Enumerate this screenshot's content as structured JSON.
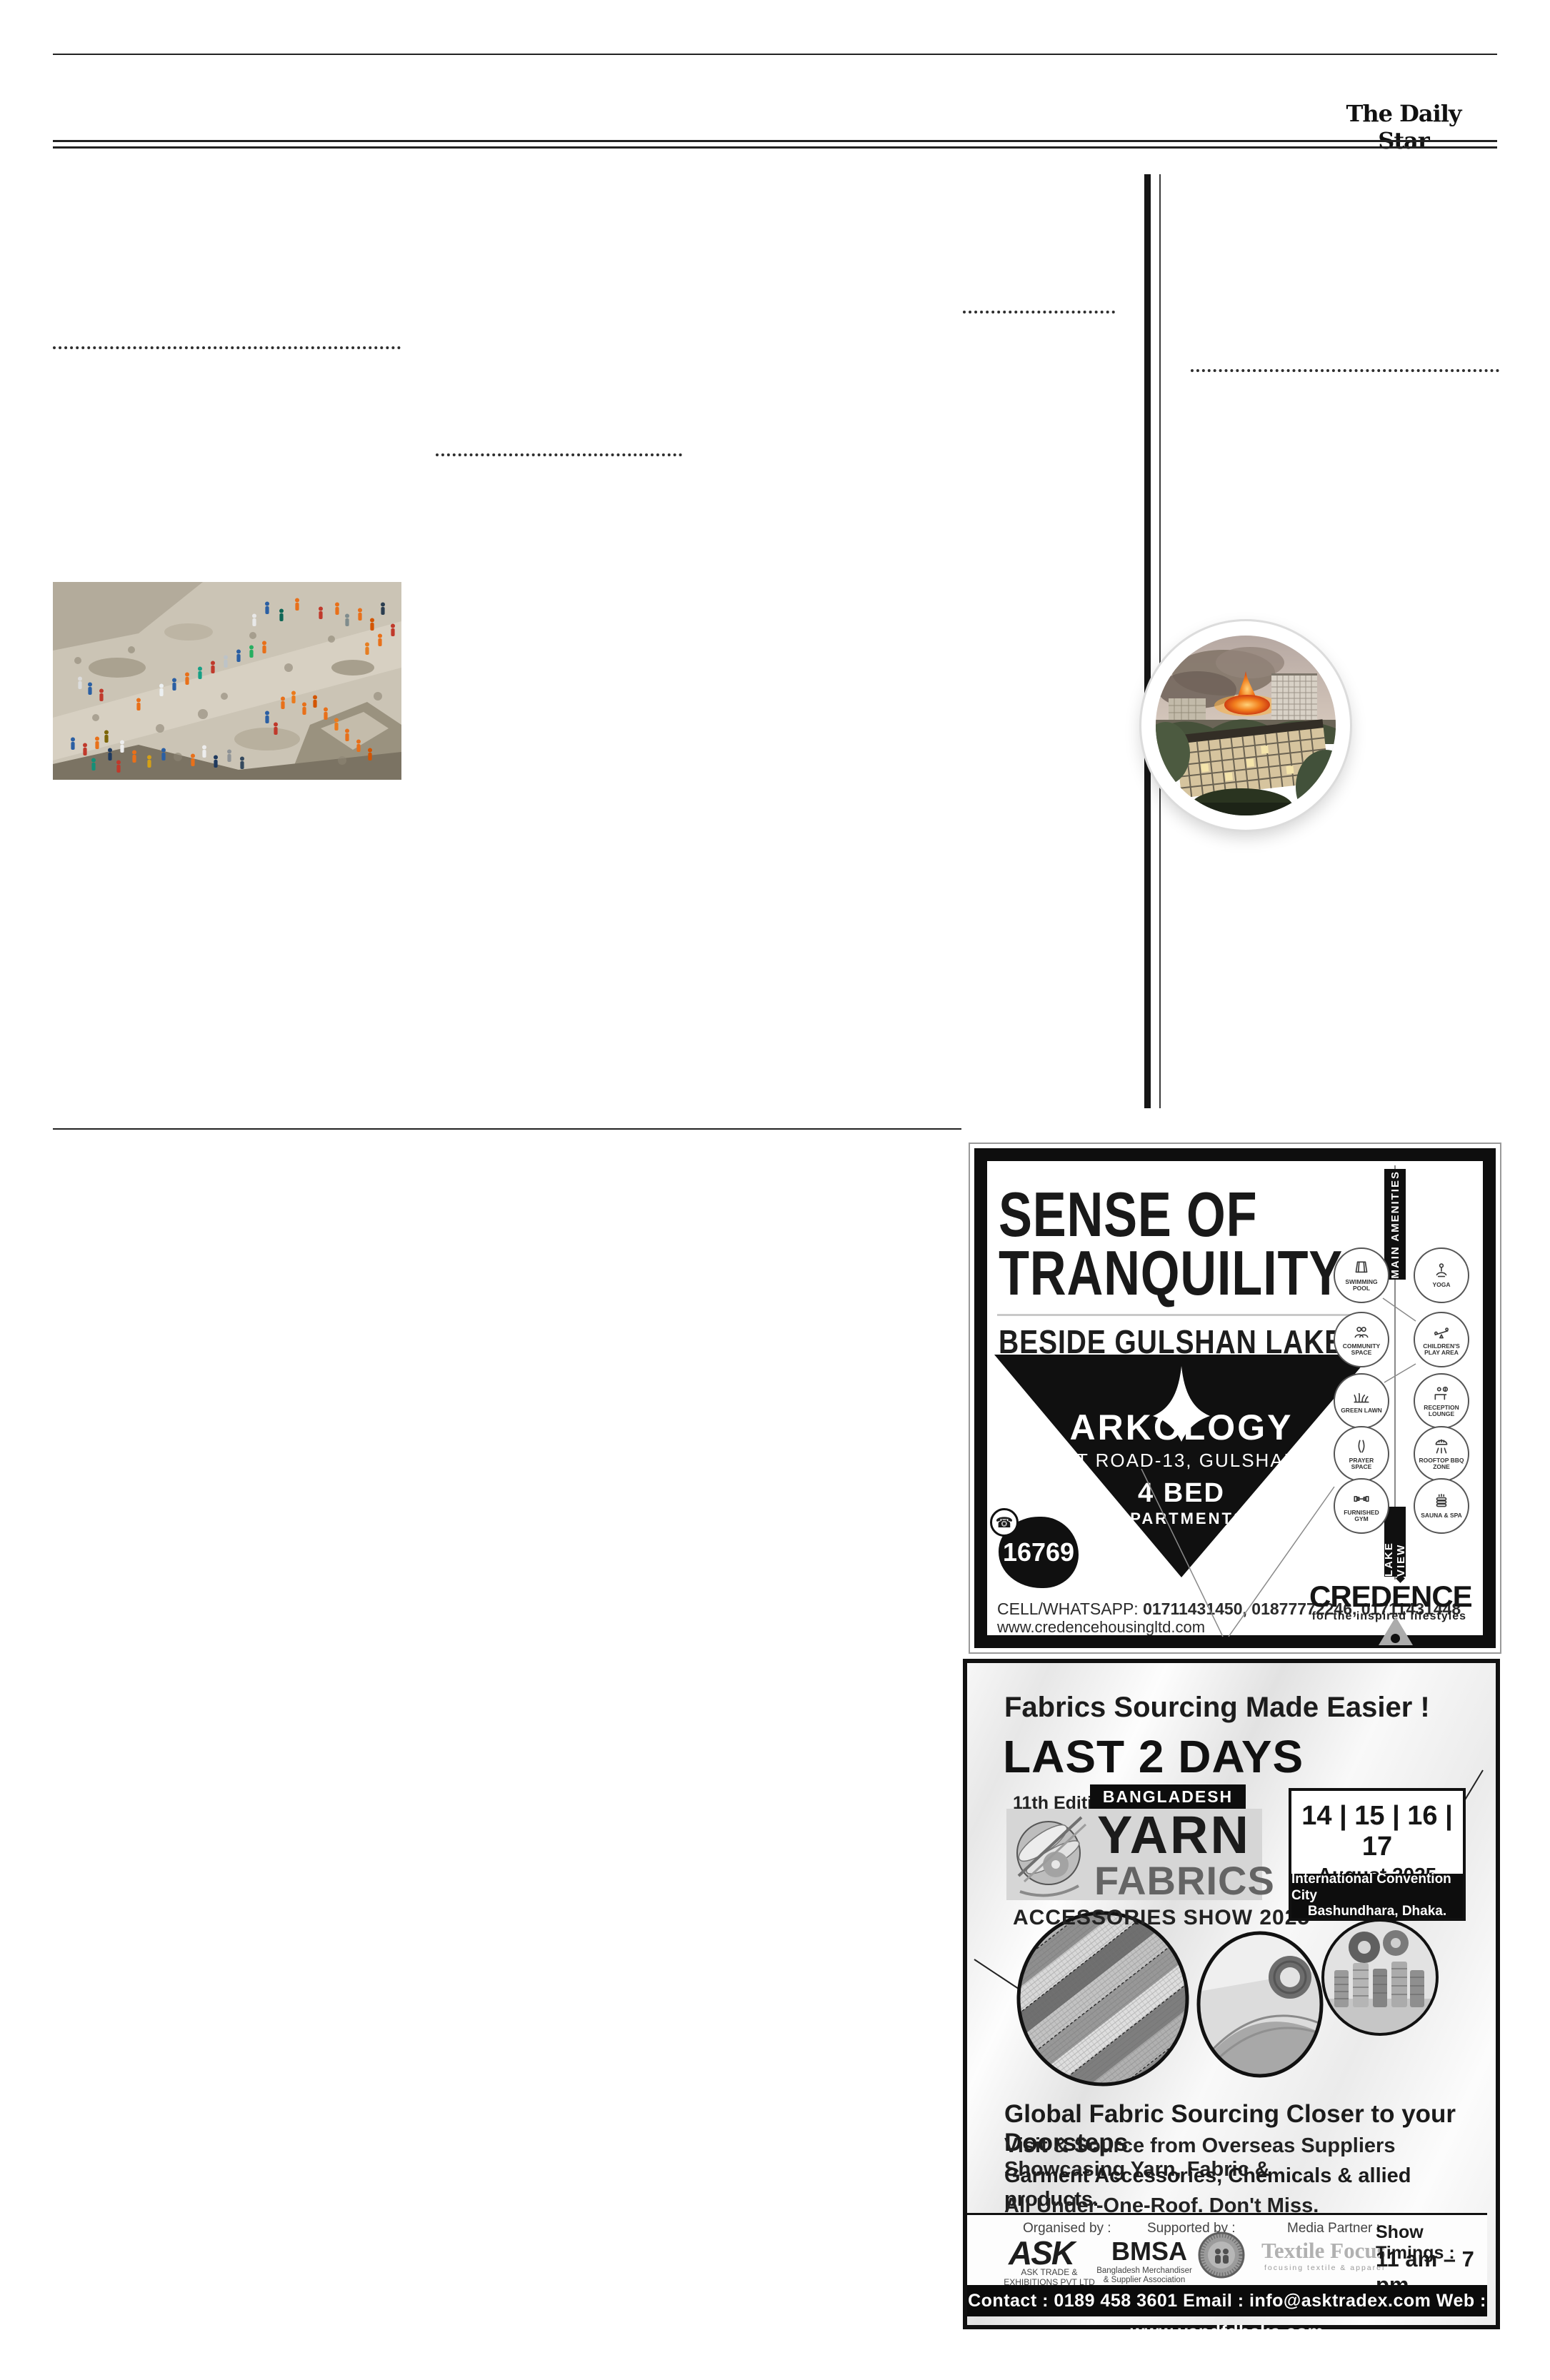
{
  "masthead": {
    "title": "The Daily Star"
  },
  "icons": {
    "phone_glyph": "☎"
  },
  "arkology_ad": {
    "headline_line1": "SENSE OF",
    "headline_line2": "TRANQUILITY",
    "subheadline": "BESIDE GULSHAN LAKE.",
    "brand": "ARKOLOGY",
    "address": "AT ROAD-13, GULSHAN",
    "offer_line1": "4 BED",
    "offer_line2": "APARTMENTS",
    "hotline": "16769",
    "contact_label": "CELL/WHATSAPP:",
    "contact_numbers": "01711431450, 01877772246, 01711431448",
    "website": "www.credencehousingltd.com",
    "amenities_title": "MAIN AMENITIES",
    "amenities": [
      "SWIMMING POOL",
      "YOGA",
      "COMMUNITY SPACE",
      "CHILDREN'S PLAY AREA",
      "GREEN LAWN",
      "RECEPTION LOUNGE",
      "PRAYER SPACE",
      "ROOFTOP BBQ ZONE",
      "FURNISHED GYM",
      "SAUNA & SPA"
    ],
    "lake_view_label": "LAKE VIEW",
    "developer": "CREDENCE",
    "developer_tagline": "for the inspired lifestyles"
  },
  "yarn_ad": {
    "tagline": "Fabrics Sourcing Made Easier !",
    "urgency": "LAST 2 DAYS",
    "edition": "11th Edition",
    "country": "BANGLADESH",
    "logo_line1": "YARN",
    "logo_line2": "FABRICS",
    "show_name": "ACCESSORIES SHOW 2025",
    "dates": "14 | 15 | 16 | 17",
    "month_year": "August 2025",
    "venue_line1": "International Convention City",
    "venue_line2": "Bashundhara, Dhaka.",
    "body_heading": "Global Fabric Sourcing Closer to your Doorsteps",
    "body_line1": "Visit & Source from Overseas Suppliers Showcasing Yarn, Fabric &",
    "body_line2": "Garment Accessories, Chemicals & allied products.",
    "body_line3": "All Under-One-Roof. Don't Miss.",
    "organised_by_label": "Organised by :",
    "organiser_logo": "ASK",
    "organiser_name1": "ASK TRADE &",
    "organiser_name2": "EXHIBITIONS PVT LTD",
    "supported_by_label": "Supported by :",
    "supporter_logo": "BMSA",
    "supporter_name1": "Bangladesh Merchandiser",
    "supporter_name2": "& Supplier Association",
    "media_partner_label": "Media Partner :",
    "media_partner_name": "Textile Focus",
    "media_partner_tagline": "focusing  textile  &  apparel",
    "show_timings_label": "Show Timings :",
    "show_timings_value": "11 am – 7 pm",
    "contact_bar": "Contact : 0189 458 3601 Email : info@asktradex.com Web : www.yandfdhaka.com"
  }
}
